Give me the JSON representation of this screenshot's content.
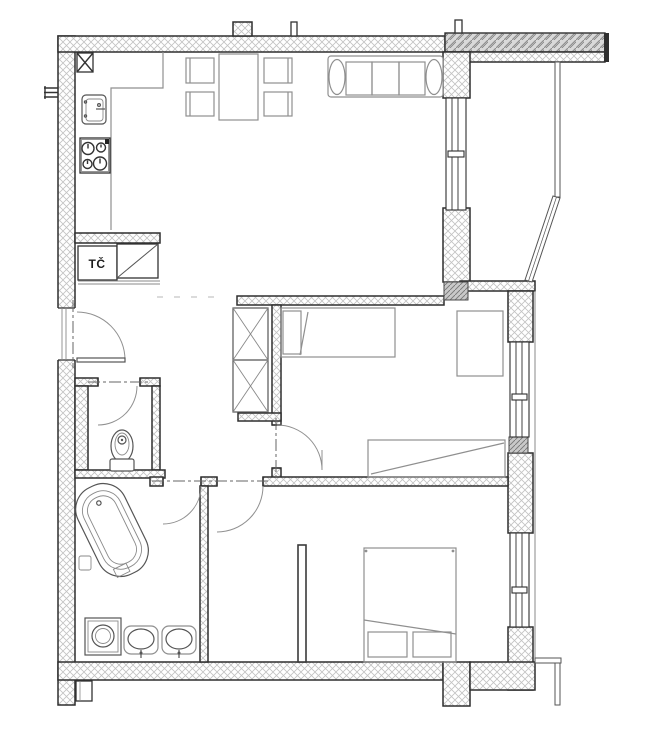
{
  "labels": {
    "heat_pump": "TČ"
  },
  "colors": {
    "background": "#ffffff",
    "wall_outline": "#2f2f2f",
    "wall_hatch": "#c2c2c2",
    "slab_fill": "#d9d9d9",
    "slab_hatch": "#8f8f8f",
    "column_fill": "#c9c9c9",
    "furniture_line": "#8f8f8f",
    "fixture_line": "#555555",
    "door_arc": "#909090",
    "centerline": "#666666"
  }
}
